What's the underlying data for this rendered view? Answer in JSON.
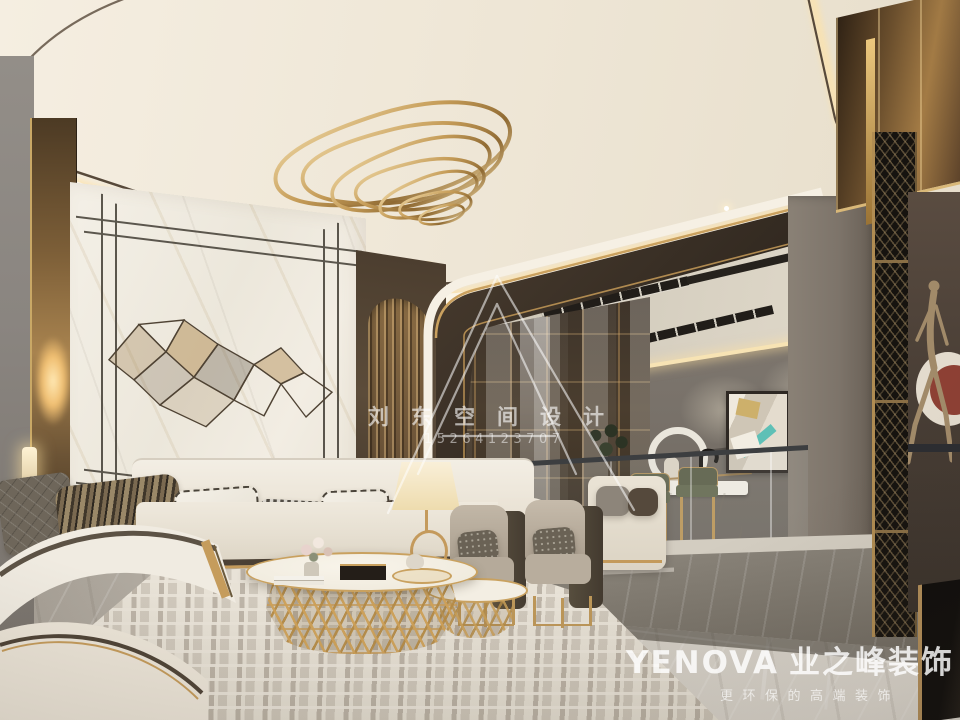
{
  "watermarks": {
    "center": {
      "logo": "triangle-A-monogram",
      "title": "刘东空间设计",
      "phone": "15264123707"
    },
    "corner": {
      "brand_latin": "YENOVA",
      "brand_cjk": "业之峰装饰",
      "tagline": "更环保的高端装饰"
    }
  },
  "scene": {
    "type": "luxury-living-room-interior-render",
    "elements": [
      "cream coffered ceiling with warm cove lighting",
      "gold wavy ring chandelier",
      "white marble feature wall with thin black frame lines and brass geometric wall art",
      "white leather curved sofa with striped, houndstooth and medusa-print pillows",
      "gold lattice oval coffee tables with decor",
      "two taupe armchairs with dark side panels and gold legs",
      "raised bar lounge with olive-green stools, black faucet, round wall decor and abstract art",
      "glass balustrade and grey marble steps",
      "bronze walking-figure sculpture against dark wall with red circle art",
      "patterned cream area rug on grey marble floor"
    ]
  },
  "palette": {
    "gold": "#c49a5e",
    "ceiling_cream": "#f0e9db",
    "wall_grey": "#7a736b",
    "dark_wood": "#3a312a",
    "marble_white": "#f1ece3",
    "floor_grey": "#bfb9af",
    "accent_teal": "#5fc0b6",
    "accent_red": "#8d4034",
    "olive_stool": "#63664e",
    "watermark_white": "rgba(255,255,255,0.78)"
  }
}
